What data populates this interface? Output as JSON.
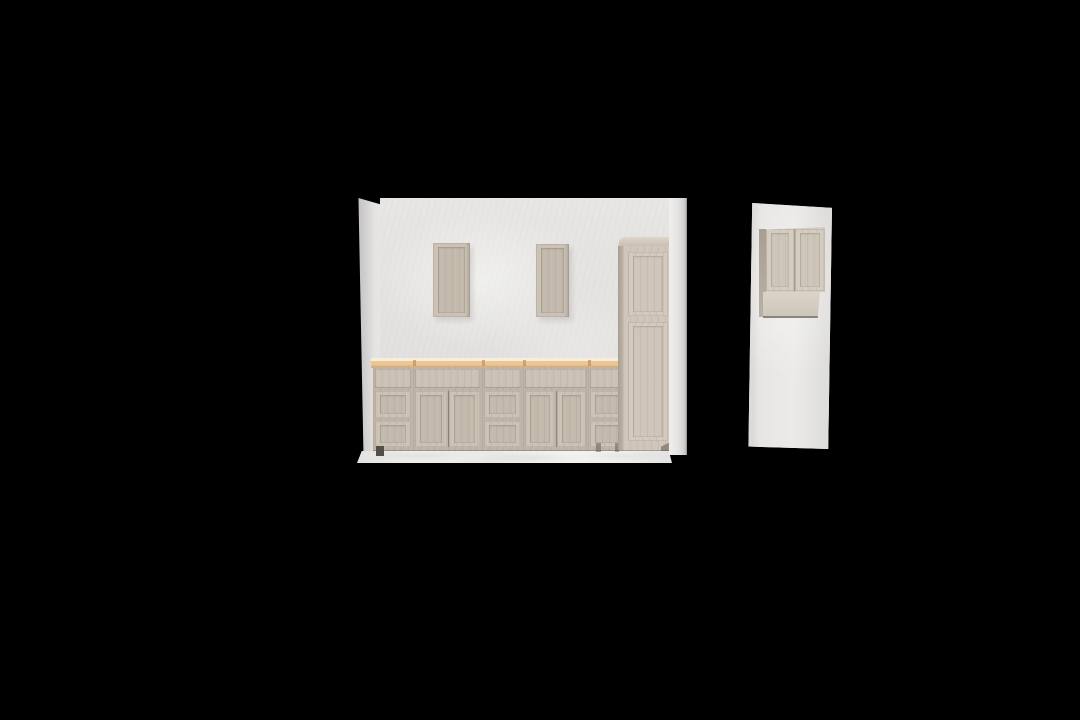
{
  "viewport": {
    "description": "3D kitchen planner render viewport, front elevation on black background",
    "visible_text": "none"
  },
  "scene_objects": [
    {
      "name": "left-return-wall"
    },
    {
      "name": "back-wall"
    },
    {
      "name": "right-return-wall"
    },
    {
      "name": "floor"
    },
    {
      "name": "wall-cabinet-single-door-left"
    },
    {
      "name": "wall-cabinet-single-door-right"
    },
    {
      "name": "base-cabinet-3-drawer",
      "count": 3
    },
    {
      "name": "base-cabinet-2-door-with-drawer",
      "count": 2
    },
    {
      "name": "butcher-block-countertop"
    },
    {
      "name": "tall-pantry-cabinet"
    },
    {
      "name": "side-wall-panel"
    },
    {
      "name": "side-wall-cabinet-2-door"
    }
  ],
  "colors": {
    "background": "#000000",
    "wall": "#e7e6e4",
    "wall_deep": "#dfdedc",
    "pillar_dark": "#c3c2c0",
    "pillar_light": "#e4e3e1",
    "pillar_bright": "#f0efed",
    "floor": "#efeeec",
    "floor_shade": "#e3e2e0",
    "cabinet": "#beb4a7",
    "cabinet_frame": "#cbc1b4",
    "cabinet_panel": "#c3b9ac",
    "cabinet_gap": "#9a9084",
    "cabinet_side": "#a89e92",
    "cabinet_tall": "#cfc5b8",
    "cabinet_tall_frame": "#d3c9bc",
    "crown_light": "#ded5c9",
    "crown_dark": "#c9bfb2",
    "counter_light": "#f6eedd",
    "counter_wood": "#ecc795",
    "counter_streak": "#c8915a",
    "underside_light": "#dcd4c8",
    "underside_dark": "#cec6ba",
    "sidecab_frame": "#d5ccc0",
    "sidecab_panel": "#cec5b9",
    "edge_dark": "#8b847b",
    "foot": "#544e48"
  }
}
